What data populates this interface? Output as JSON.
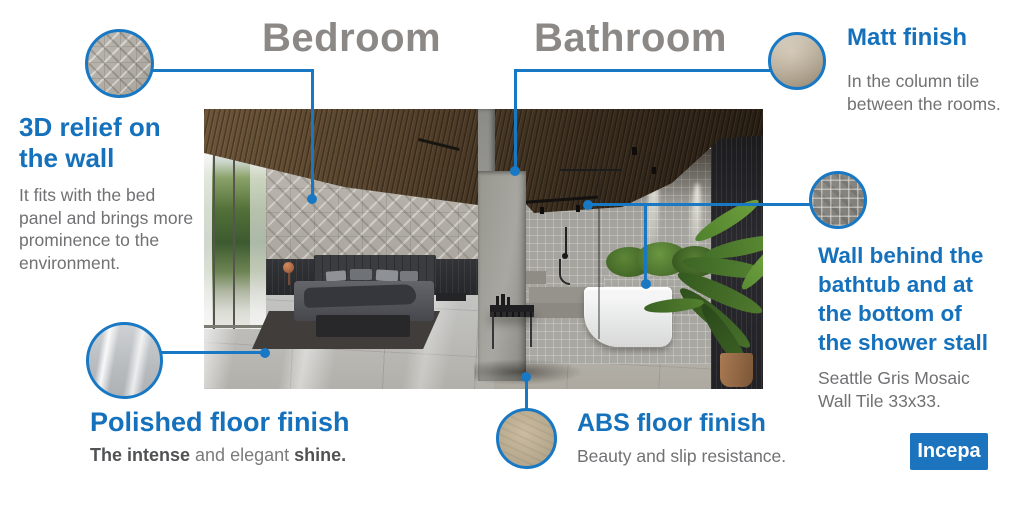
{
  "titles": {
    "bedroom": "Bedroom",
    "bathroom": "Bathroom"
  },
  "colors": {
    "accent_blue": "#1878c4",
    "heading_blue": "#1571bb",
    "title_gray": "#8b8885",
    "body_gray": "#717174",
    "logo_blue": "#1b74bd"
  },
  "callouts": {
    "relief": {
      "heading": "3D relief on\nthe wall",
      "body": "It fits with the bed\npanel and brings more\nprominence to the\nenvironment."
    },
    "matt": {
      "heading": "Matt finish",
      "body": "In the column tile\nbetween the rooms."
    },
    "wall": {
      "heading": "Wall behind the\nbathtub and at\nthe bottom of\nthe shower stall",
      "body": "Seattle Gris Mosaic\nWall Tile 33x33."
    },
    "polished": {
      "heading": "Polished floor finish",
      "body_bold1": "The intense",
      "body_mid": " and elegant ",
      "body_bold2": "shine."
    },
    "abs": {
      "heading": "ABS floor finish",
      "body": "Beauty and slip resistance."
    }
  },
  "logo": {
    "text": "Incepa"
  }
}
